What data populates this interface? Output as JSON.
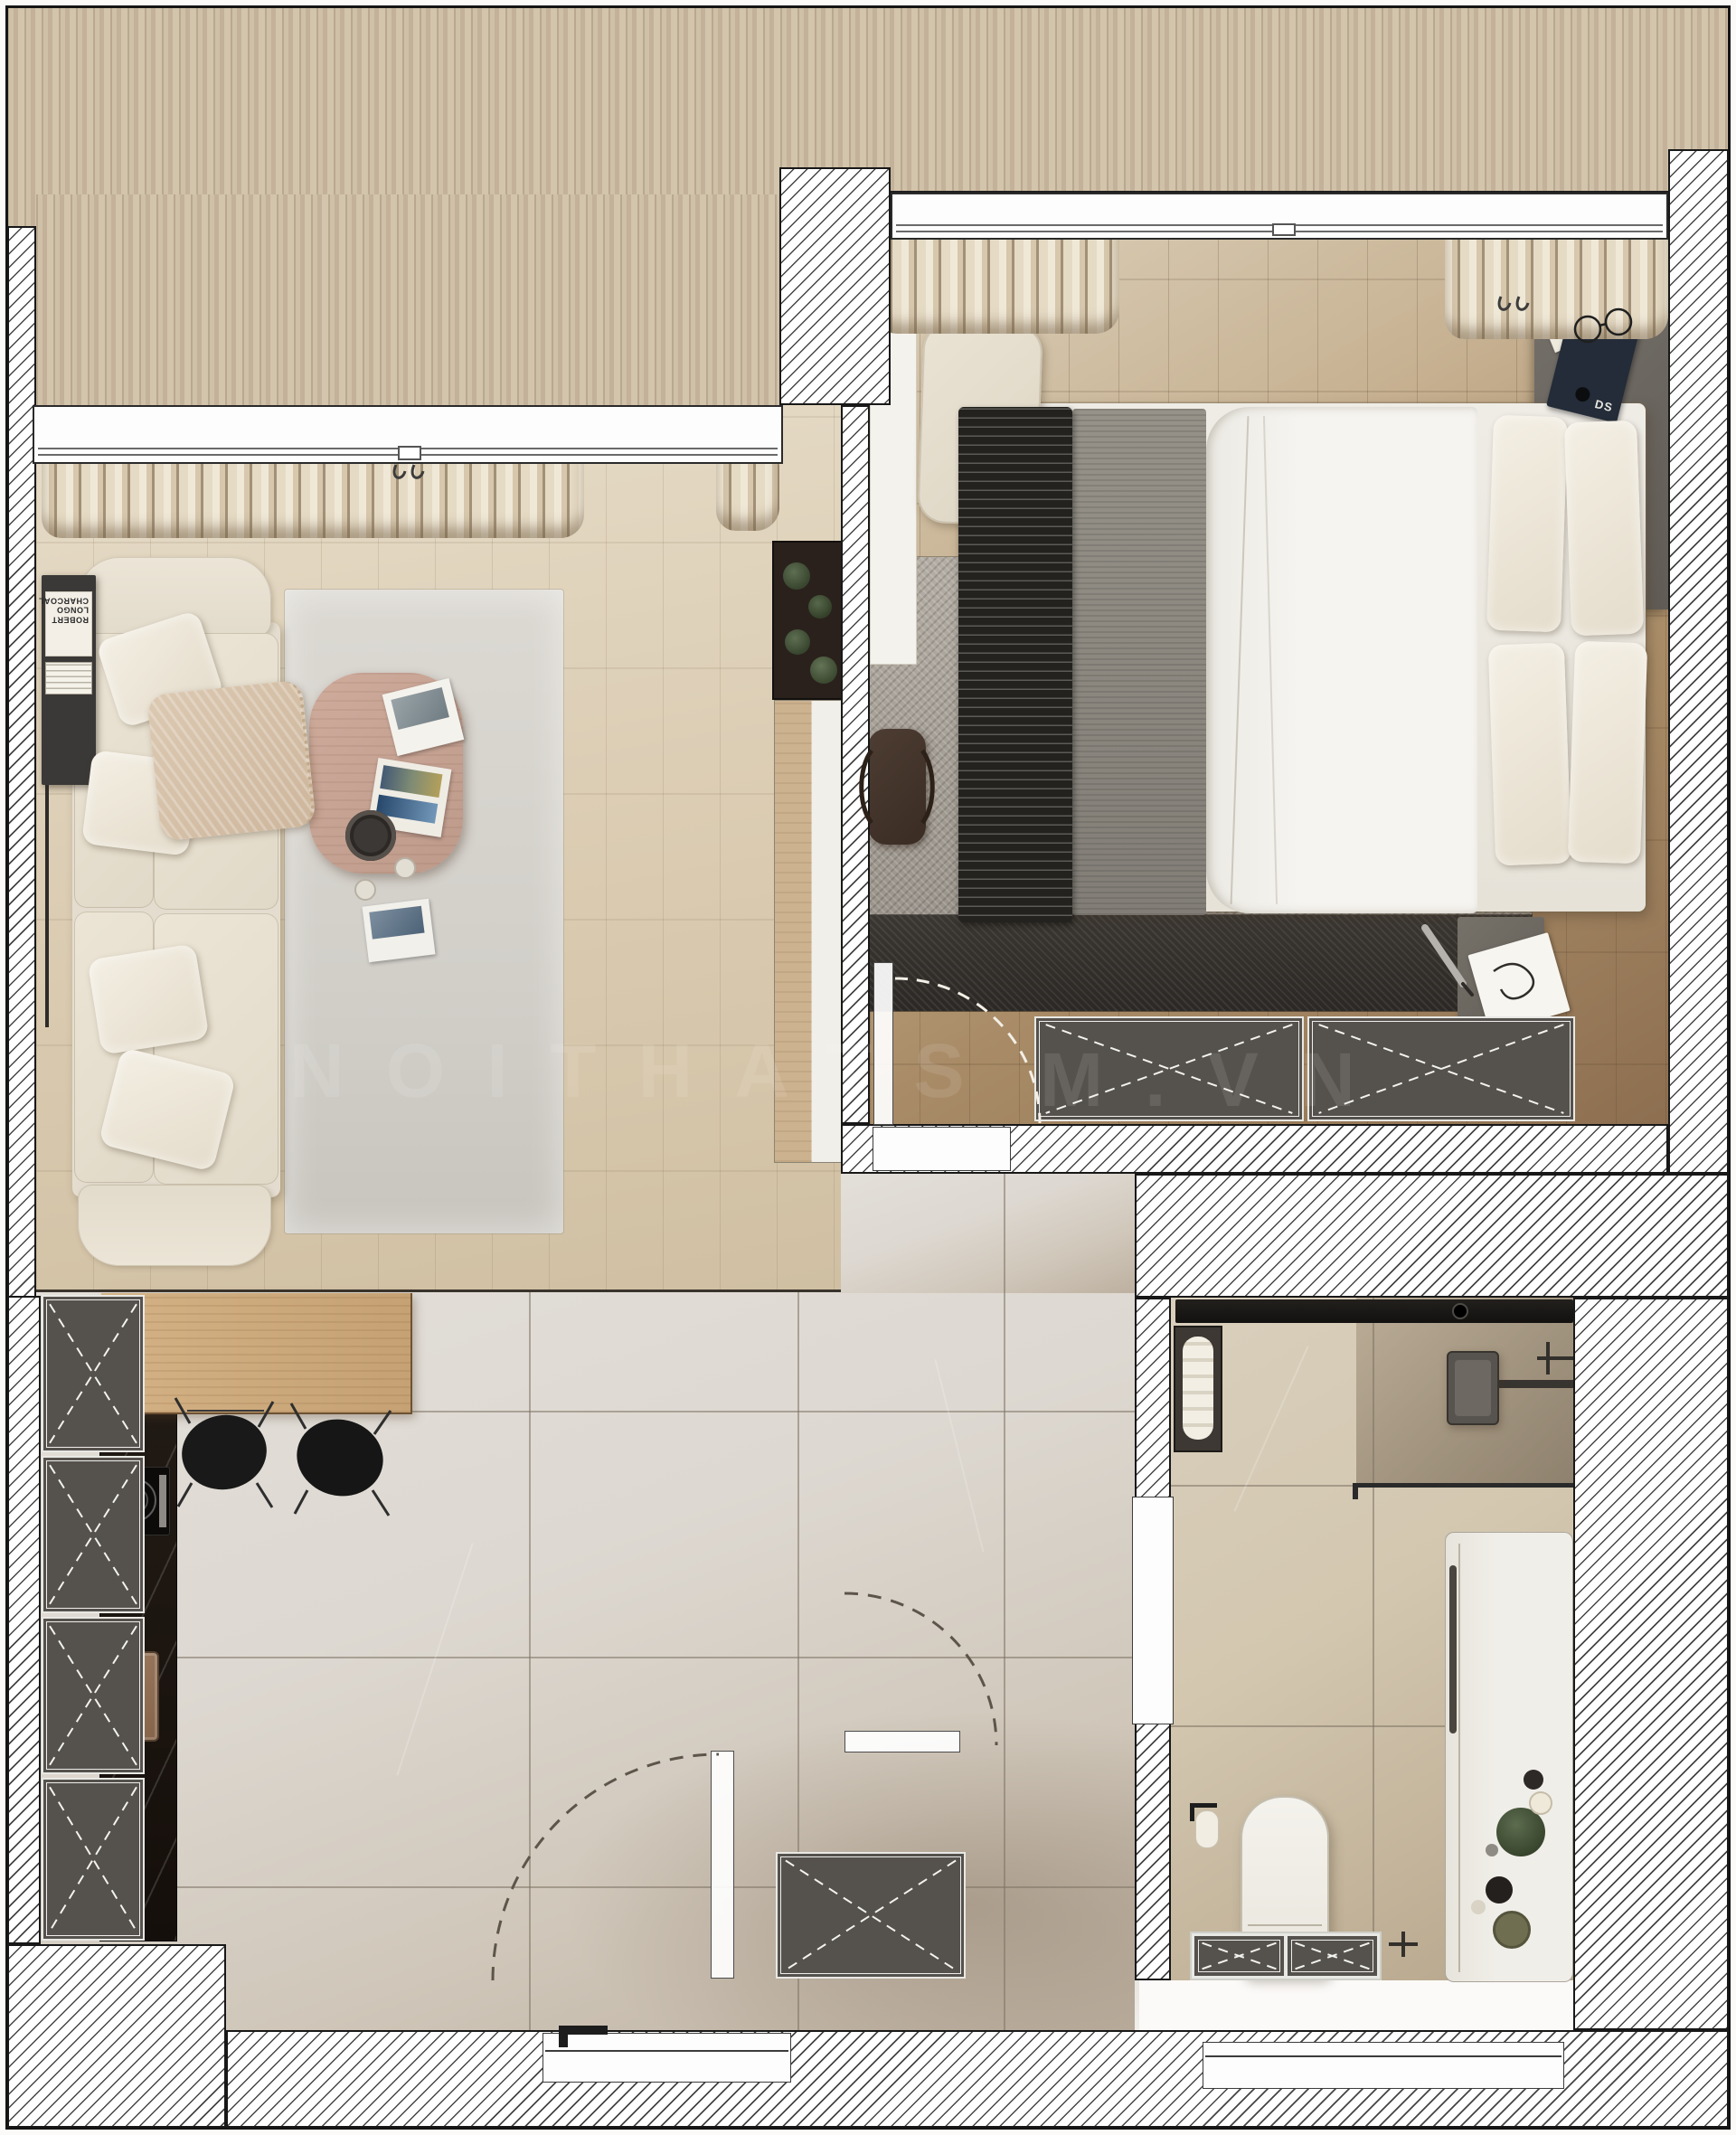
{
  "document": {
    "kind": "apartment floor plan – rendered top view",
    "rooms": [
      "living-room",
      "bedroom",
      "kitchen-dining",
      "hallway",
      "bathroom",
      "balcony-deck"
    ]
  },
  "watermark": {
    "left": "NOITHATS",
    "right": "M.VN"
  },
  "living_room": {
    "shelf_book_spine": "ROBERT LONGO CHARCOAL",
    "items": [
      "corner-sofa",
      "pillows",
      "knit-throw",
      "side-shelf",
      "area-rug",
      "coffee-table",
      "magazines",
      "tray",
      "cups",
      "planter-cacti",
      "tv-cabinet",
      "curtains"
    ]
  },
  "bedroom": {
    "nightstand_book_cover": "DS",
    "items": [
      "double-bed",
      "pillows",
      "black-zigzag-throw",
      "gray-blanket",
      "white-duvet",
      "distressed-rug",
      "desk",
      "bench",
      "corner-shelf",
      "glasses",
      "duffel-bag",
      "nightstand",
      "pen",
      "note-paper",
      "wardrobe-2x",
      "curtains"
    ]
  },
  "kitchen": {
    "items": [
      "tall-cabinet-column-4x",
      "black-stone-counter",
      "induction-hob",
      "cutting-board",
      "wood-dining-table",
      "black-wire-chair-2x"
    ]
  },
  "hallway": {
    "items": [
      "shoe-cabinet",
      "entry-door-swing",
      "bathroom-door-swing"
    ]
  },
  "bathroom": {
    "items": [
      "shower-channel",
      "rain-shower-head",
      "shower-glass",
      "towel-niche",
      "bathtub-deck",
      "towel-bar",
      "plant",
      "trays",
      "wall-hung-toilet",
      "toilet-paper-holder",
      "vanity-cabinet",
      "faucet"
    ]
  },
  "symbols": {
    "dashed_x_panel": "storage / wardrobe unit",
    "dashed_arc": "door swing",
    "diagonal_hatch": "wall section",
    "vertical_slats": "balcony decking"
  },
  "colors": {
    "wall_hatch_line": "#454545",
    "wall_border": "#181818",
    "deck_wood": "#c9b89f",
    "living_floor": "#d8cab2",
    "bedroom_floor_dark": "#8a6c4e",
    "hall_tile": "#d9d4cd",
    "bath_tile": "#cfc3aa",
    "storage_gray": "#55514c",
    "counter_black": "#17110c",
    "table_wood": "#c9a87c",
    "coffee_table_wood": "#c6a394",
    "sofa_cream": "#e7e0d2",
    "rug_living": "#d6d3cd",
    "rug_bedroom": "#a7a199",
    "rug_bedroom_dark": "#2f2c28",
    "plant_green": "#46543e"
  }
}
